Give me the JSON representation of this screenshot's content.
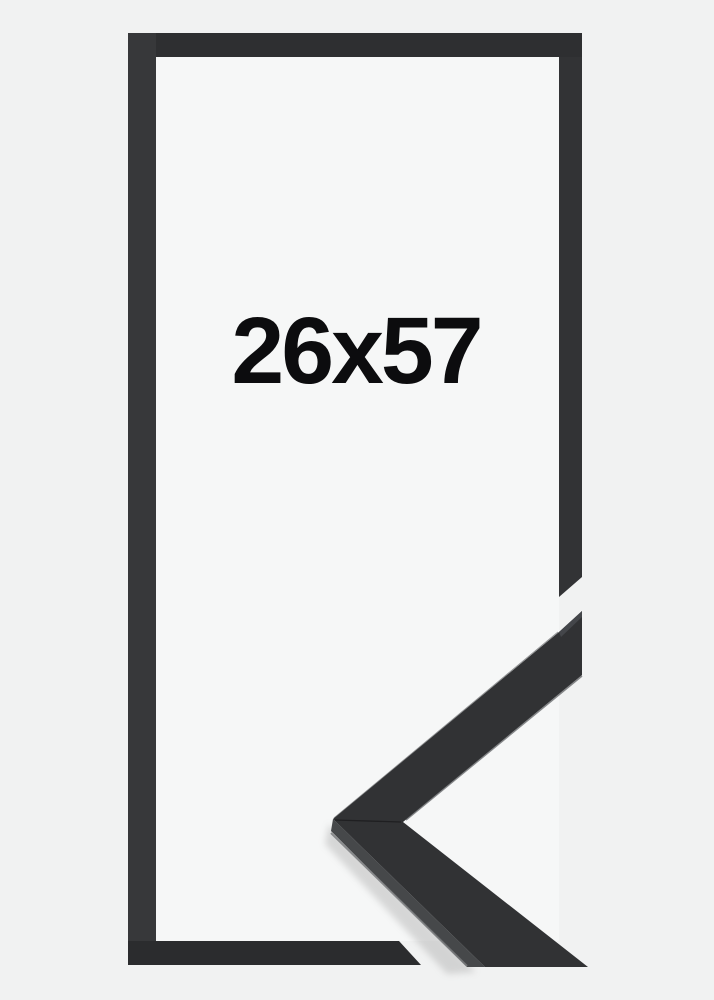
{
  "product": {
    "size_label": "26x57",
    "frame_style": "black-flat-moulding",
    "colors": {
      "background": "#f1f2f2",
      "opening": "#f6f7f7",
      "frame_top": "#2e2f31",
      "frame_left": "#37383a",
      "frame_right": "#323335",
      "frame_bottom": "#2b2c2e",
      "moulding_front": "#313234",
      "moulding_side": "#46484a",
      "moulding_end_grain": "#44464a",
      "label_text": "#0c0c0e",
      "shadow": "#9a9a9a"
    }
  }
}
